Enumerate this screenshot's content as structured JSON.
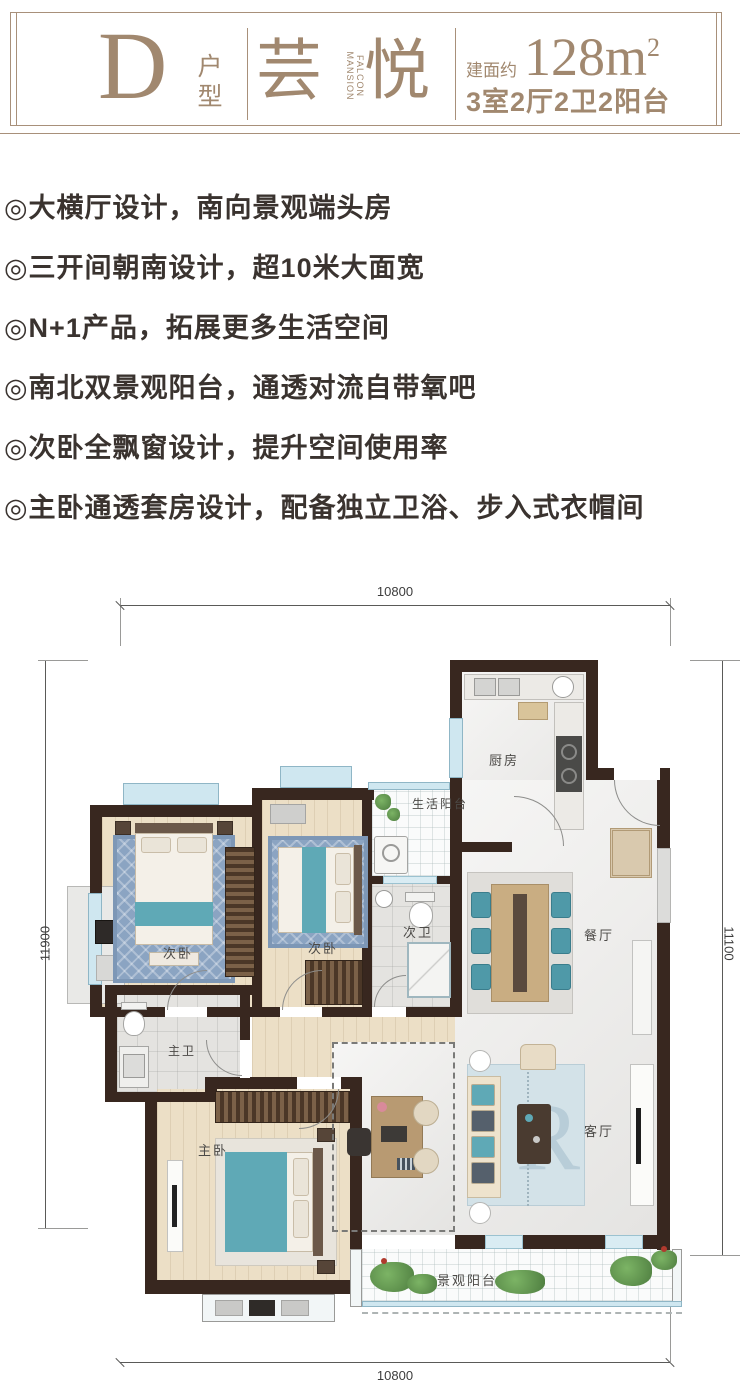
{
  "header": {
    "unit_letter": "D",
    "unit_type_label": "户型",
    "brand_first": "芸",
    "brand_second": "悦",
    "brand_en_line1": "FALCON",
    "brand_en_line2": "MANSION",
    "area_prefix": "建面约",
    "area_number": "128m",
    "area_sup": "2",
    "layout_spec": "3室2厅2卫2阳台"
  },
  "features": [
    "◎大横厅设计，南向景观端头房",
    "◎三开间朝南设计，超10米大面宽",
    "◎N+1产品，拓展更多生活空间",
    "◎南北双景观阳台，通透对流自带氧吧",
    "◎次卧全飘窗设计，提升空间使用率",
    "◎主卧通透套房设计，配备独立卫浴、步入式衣帽间"
  ],
  "floorplan": {
    "rooms": {
      "kitchen": "厨房",
      "service_balcony": "生活阳台",
      "second_bath": "次卫",
      "second_bedroom_left": "次卧",
      "second_bedroom_mid": "次卧",
      "dining": "餐厅",
      "master_bath": "主卫",
      "master_bedroom": "主卧",
      "living": "客厅",
      "view_balcony": "景观阳台"
    },
    "dimensions": {
      "top": "10800",
      "left": "11900",
      "right": "11100",
      "bottom": "10800"
    },
    "rug_monogram": "R"
  },
  "colors": {
    "brand_brown": "#a1886f",
    "wall_dark": "#38271f",
    "accent_teal": "#5fa9b6"
  }
}
